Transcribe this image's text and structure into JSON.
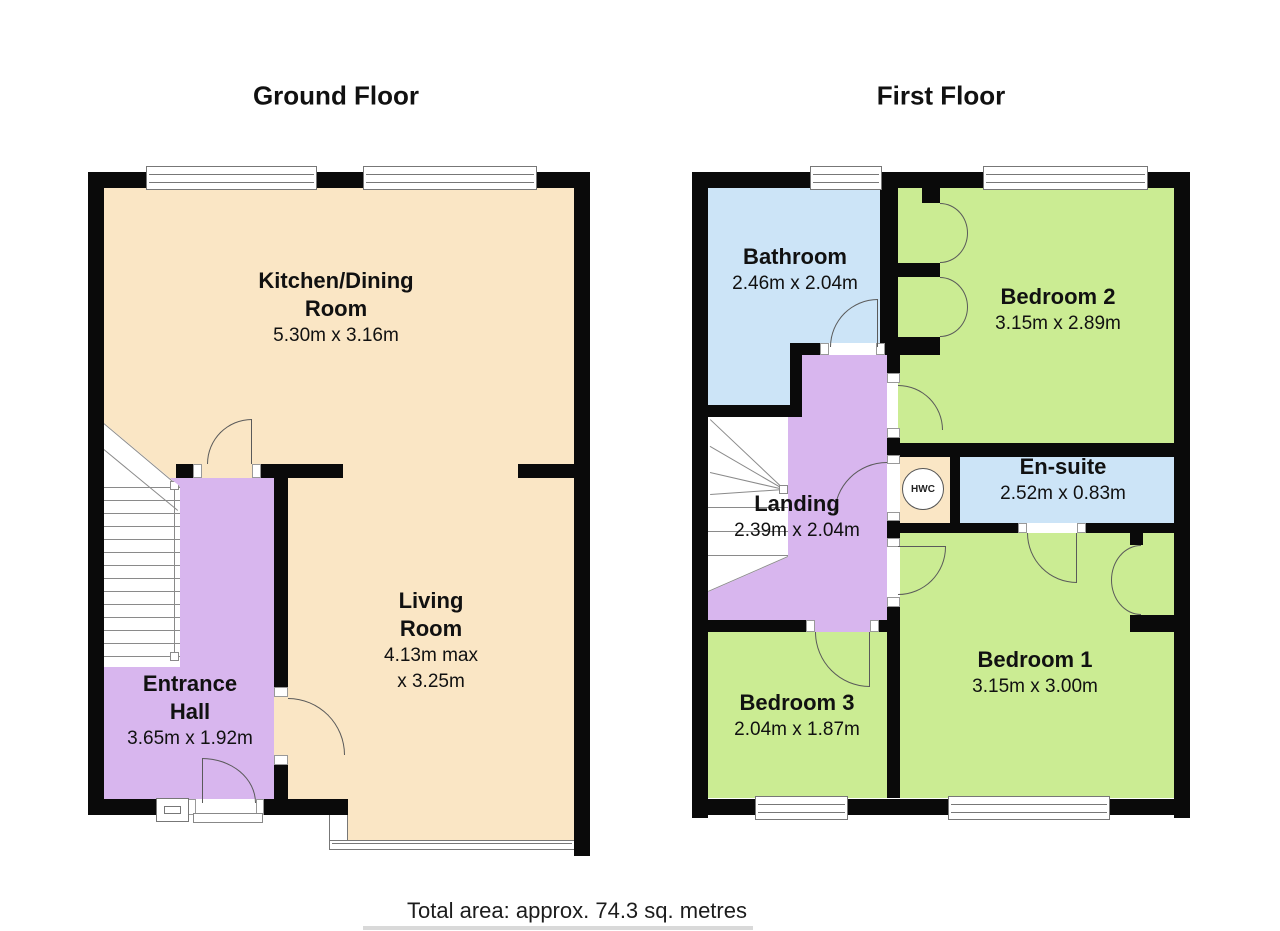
{
  "titles": {
    "ground_floor": "Ground Floor",
    "first_floor": "First Floor"
  },
  "footer": {
    "total_area": "Total area: approx. 74.3 sq. metres"
  },
  "ground_floor": {
    "kitchen": {
      "name1": "Kitchen/Dining",
      "name2": "Room",
      "dims": "5.30m x 3.16m"
    },
    "living": {
      "name1": "Living",
      "name2": "Room",
      "dims1": "4.13m max",
      "dims2": "x 3.25m"
    },
    "entrance": {
      "name1": "Entrance",
      "name2": "Hall",
      "dims": "3.65m x 1.92m"
    }
  },
  "first_floor": {
    "bathroom": {
      "name": "Bathroom",
      "dims": "2.46m x 2.04m"
    },
    "bedroom2": {
      "name": "Bedroom 2",
      "dims": "3.15m x 2.89m"
    },
    "ensuite": {
      "name": "En-suite",
      "dims": "2.52m x 0.83m"
    },
    "landing": {
      "name": "Landing",
      "dims": "2.39m x 2.04m"
    },
    "bedroom3": {
      "name": "Bedroom 3",
      "dims": "2.04m x 1.87m"
    },
    "bedroom1": {
      "name": "Bedroom 1",
      "dims": "3.15m x 3.00m"
    },
    "hwc": {
      "label": "HWC"
    }
  },
  "colors": {
    "wall": "#0a0a0a",
    "kitchen_living_floor": "#FAE6C5",
    "hall_landing_floor": "#D8B6EE",
    "bathroom_floor": "#CCE4F7",
    "bedroom_floor": "#CBEC93",
    "door_line": "#5a5a5a",
    "frame": "#777777",
    "text": "#111111"
  }
}
